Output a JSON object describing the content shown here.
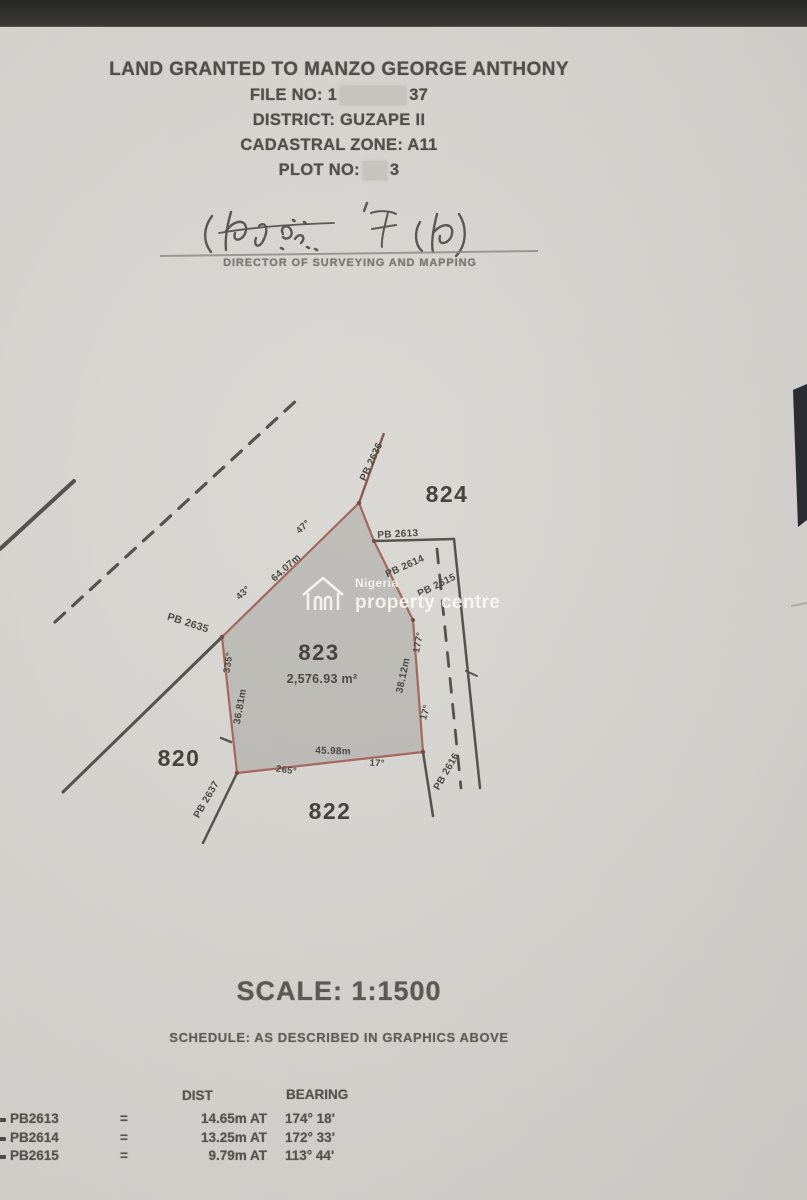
{
  "header": {
    "line1": "LAND GRANTED TO MANZO GEORGE ANTHONY",
    "file_no_prefix": "FILE NO: 1",
    "file_no_suffix": "37",
    "district": "DISTRICT: GUZAPE II",
    "cadastral_zone": "CADASTRAL ZONE: A11",
    "plot_no_prefix": "PLOT NO:",
    "plot_no_suffix": "3"
  },
  "signature": {
    "caption": "DIRECTOR OF SURVEYING AND MAPPING"
  },
  "watermark": {
    "line1": "Nigeria",
    "line2": "property centre"
  },
  "footer": {
    "scale": "SCALE: 1:1500",
    "schedule": "SCHEDULE: AS DESCRIBED IN GRAPHICS ABOVE"
  },
  "table": {
    "headers": {
      "dist": "DIST",
      "bearing": "BEARING"
    },
    "rows": [
      {
        "point": "PB2613",
        "eq": "=",
        "dist": "14.65m  AT",
        "bearing": "174° 18'"
      },
      {
        "point": "PB2614",
        "eq": "=",
        "dist": "13.25m  AT",
        "bearing": "172° 33'"
      },
      {
        "point": "PB2615",
        "eq": "=",
        "dist": "9.79m  AT",
        "bearing": "113° 44'"
      }
    ]
  },
  "map": {
    "plot_area": "2,576.93 m²",
    "plot_number": "823",
    "neighbour_plots": [
      "824",
      "820",
      "822"
    ],
    "scale_ratio": "1:1500",
    "labels": [
      {
        "text": "824",
        "x": 447,
        "y": 502,
        "s": 23,
        "r": 0,
        "cls": "plot-num"
      },
      {
        "text": "823",
        "x": 319,
        "y": 660,
        "s": 22,
        "r": 0,
        "cls": "plot-num"
      },
      {
        "text": "2,576.93 m²",
        "x": 322,
        "y": 683,
        "s": 12.5,
        "r": 0,
        "cls": ""
      },
      {
        "text": "820",
        "x": 179,
        "y": 766,
        "s": 23,
        "r": 0,
        "cls": "plot-num"
      },
      {
        "text": "822",
        "x": 330,
        "y": 819,
        "s": 23,
        "r": 0,
        "cls": "plot-num"
      },
      {
        "text": "PB 2635",
        "x": 187,
        "y": 626,
        "s": 10.5,
        "r": 18,
        "cls": ""
      },
      {
        "text": "PB 2636",
        "x": 374,
        "y": 463,
        "s": 10,
        "r": -65,
        "cls": ""
      },
      {
        "text": "PB 2613",
        "x": 398,
        "y": 537,
        "s": 10,
        "r": -3,
        "cls": ""
      },
      {
        "text": "PB 2614",
        "x": 406,
        "y": 569,
        "s": 10,
        "r": -24,
        "cls": ""
      },
      {
        "text": "PB 2615",
        "x": 438,
        "y": 588,
        "s": 10,
        "r": -26,
        "cls": ""
      },
      {
        "text": "PB 2616",
        "x": 449,
        "y": 773,
        "s": 10,
        "r": -60,
        "cls": ""
      },
      {
        "text": "PB 2637",
        "x": 209,
        "y": 801,
        "s": 10,
        "r": -60,
        "cls": ""
      },
      {
        "text": "64.07m",
        "x": 288,
        "y": 570,
        "s": 10,
        "r": -42,
        "cls": ""
      },
      {
        "text": "47°",
        "x": 305,
        "y": 529,
        "s": 9.5,
        "r": -42,
        "cls": ""
      },
      {
        "text": "43°",
        "x": 245,
        "y": 595,
        "s": 9.5,
        "r": -42,
        "cls": ""
      },
      {
        "text": "335°",
        "x": 231,
        "y": 663,
        "s": 9.5,
        "r": -82,
        "cls": ""
      },
      {
        "text": "36.81m",
        "x": 243,
        "y": 707,
        "s": 10,
        "r": -80,
        "cls": ""
      },
      {
        "text": "38.12m",
        "x": 406,
        "y": 676,
        "s": 10,
        "r": -78,
        "cls": ""
      },
      {
        "text": "177°",
        "x": 421,
        "y": 643,
        "s": 9.5,
        "r": -78,
        "cls": ""
      },
      {
        "text": "17°",
        "x": 428,
        "y": 713,
        "s": 9.5,
        "r": -75,
        "cls": ""
      },
      {
        "text": "45.98m",
        "x": 333,
        "y": 754,
        "s": 10,
        "r": 2,
        "cls": ""
      },
      {
        "text": "265°",
        "x": 286,
        "y": 773,
        "s": 9.5,
        "r": 8,
        "cls": ""
      },
      {
        "text": "17°",
        "x": 377,
        "y": 766,
        "s": 9.5,
        "r": 3,
        "cls": ""
      }
    ]
  },
  "colors": {
    "paper": "#d6d4cf",
    "plot_border": "#a5675e",
    "plot_fill": "rgba(96,94,90,0.22)",
    "survey_line": "#55534e",
    "top_band": "#2e2d2b"
  }
}
